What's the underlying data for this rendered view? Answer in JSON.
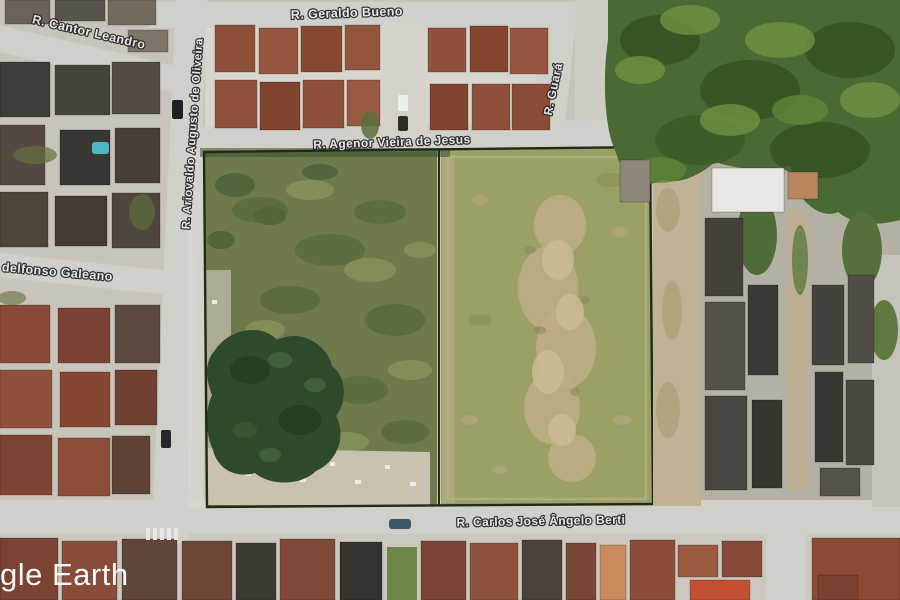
{
  "app": {
    "name": "Google Earth satellite view",
    "watermark": "gle Earth"
  },
  "map": {
    "street_labels": [
      {
        "id": "geraldo-bueno",
        "text": "R. Geraldo Bueno"
      },
      {
        "id": "cantor-leandro",
        "text": "R. Cantor Leandro"
      },
      {
        "id": "ariovaldo-augusto-de-oliveira",
        "text": "R. Ariovaldo Augusto de Oliveira"
      },
      {
        "id": "agenor-vieira-de-jesus",
        "text": "R. Agenor Vieira de Jesus"
      },
      {
        "id": "guara",
        "text": "R. Guará"
      },
      {
        "id": "idelfonso-galeano",
        "text": "delfonso Galeano"
      },
      {
        "id": "carlos-jose-angelo-berti",
        "text": "R. Carlos José Ângelo Berti"
      }
    ],
    "features": {
      "vacant-lot-left-parcel": "overgrown green parcel with tree cluster and rubble",
      "vacant-lot-right-parcel": "cleared olive field with worn dirt center",
      "housing-complex": "two clusters of rust-roofed row houses",
      "forest": "dense vegetation top-right"
    }
  },
  "palette": {
    "road": "#cfd0ca",
    "ground": "#c6c3bb",
    "complex-ground": "#d8d5ce",
    "lot-left": "#6e7a4c",
    "lot-right": "#9aa066",
    "worn-dirt": "#c0ae86",
    "forest": "#4a6a33",
    "tree-dark": "#2f4a2b",
    "shrub": "#4a6236",
    "roof-rust": "#8d4f38",
    "roof-dark": "#45403a",
    "roof-red": "#8d4a34",
    "white-roof": "#e9e7e2",
    "rubble": "#c9c2b1",
    "dirt": "#c2b295",
    "pool": "#4db6c8",
    "fence": "#202a18",
    "label-fill": "#eaeaea",
    "label-stroke": "#222222",
    "watermark": "#ffffff"
  }
}
